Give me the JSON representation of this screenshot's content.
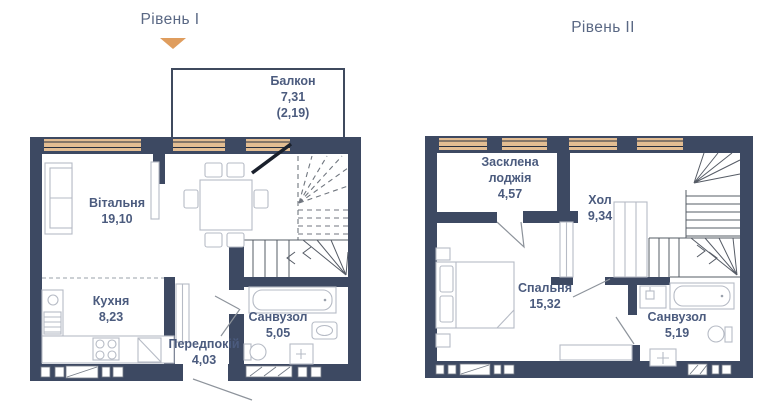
{
  "colors": {
    "wall": "#3d4962",
    "window_band": "#e3bd92",
    "marker_triangle": "#df9d5e",
    "label_text": "#4b5b7e",
    "title_text": "#5a6884"
  },
  "level1": {
    "title": "Рівень I",
    "balcony": {
      "name": "Балкон",
      "area": "7,31",
      "area_alt": "(2,19)"
    },
    "rooms": {
      "living": {
        "name": "Вітальня",
        "area": "19,10"
      },
      "kitchen": {
        "name": "Кухня",
        "area": "8,23"
      },
      "hallway": {
        "name": "Передпокій",
        "area": "4,03"
      },
      "bathroom": {
        "name": "Санвузол",
        "area": "5,05"
      }
    }
  },
  "level2": {
    "title": "Рівень II",
    "rooms": {
      "loggia": {
        "name": "Засклена лоджія",
        "area": "4,57"
      },
      "hall": {
        "name": "Хол",
        "area": "9,34"
      },
      "bedroom": {
        "name": "Спальня",
        "area": "15,32"
      },
      "bathroom": {
        "name": "Санвузол",
        "area": "5,19"
      }
    }
  }
}
